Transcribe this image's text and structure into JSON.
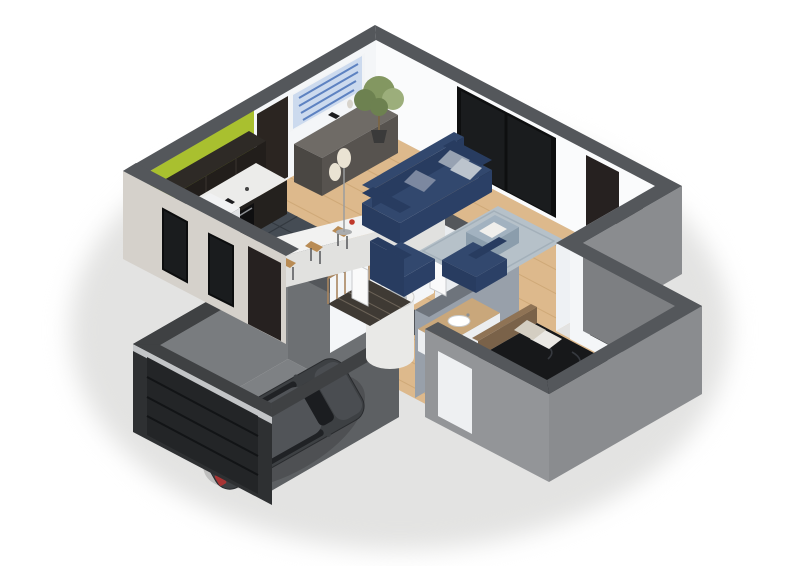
{
  "meta": {
    "type": "3d-isometric-floor-plan",
    "description": "Cutaway 3D floor plan of a one-storey house viewed from above on a white background: open kitchen, living room, bedroom, bathroom, hallway with staircase, and attached garage with a parked dark grey hatchback car",
    "background": "#ffffff"
  },
  "rooms": [
    {
      "name": "kitchen",
      "floor": "dark slate tiles",
      "features": [
        "lime green accent wall",
        "black gloss upper cabinets",
        "black base units with oven",
        "white island bar with wooden stools",
        "white fridge"
      ]
    },
    {
      "name": "living-room",
      "floor": "light oak planks",
      "features": [
        "navy three-seat sofa with grey cushions",
        "two navy cube armchairs",
        "blue-grey rug with ottoman",
        "dark sideboard",
        "blue abstract wall art",
        "potted ficus tree",
        "double floor lamp",
        "sliding glass window",
        "dark entry door"
      ]
    },
    {
      "name": "bedroom",
      "floor": "light oak planks",
      "features": [
        "double bed with dark patterned duvet",
        "wooden frame and headboard",
        "striped runner rug",
        "dark door",
        "window"
      ]
    },
    {
      "name": "bathroom",
      "features": [
        "round white shower tub",
        "wood-top vanity with basin",
        "grey feature wall"
      ]
    },
    {
      "name": "hallway",
      "features": [
        "staircase with wooden balusters and handrail",
        "white interior doors ajar"
      ]
    },
    {
      "name": "garage",
      "floor": "grey concrete",
      "features": [
        "dark grey hatchback car",
        "sectional garage door",
        "dark concrete walls"
      ]
    }
  ],
  "colors": {
    "bg": "#ffffff",
    "shadow": "#e3e3e2",
    "band": "#54575b",
    "bandGarage": "#3f4143",
    "wallWhite": "#f4f6f8",
    "wallWhite2": "#fafbfc",
    "wallWhiteShade": "#e9ecef",
    "wallInnerLight": "#eef1f4",
    "wallInnerShade": "#e3e6ea",
    "wallWarm": "#d5d1cb",
    "wallGreyRight": "#8a8c8f",
    "wallGreyWingBack": "#7d7f82",
    "wallGreyWingRight": "#939598",
    "greyFeatureWall": "#98a0aa",
    "greyFeatureBand": "#6e747c",
    "woodFloor": "#ddb98c",
    "plankLine": "#c69e6b",
    "tileFloor": "#454c54",
    "tileLine": "#333940",
    "garageFloor": "#7e8184",
    "garageSpeckle": "#6b6e71",
    "garageWallLight": "#797c7f",
    "garageWallBack": "#6d7073",
    "garageWallRight": "#5d6063",
    "garageOuterDark": "#3a3c3e",
    "garageDoorWall": "#2e3032",
    "garageDoor": "#232527",
    "garageDoorLine": "#121416",
    "garageLintel": "#c3c5c7",
    "glass": "#1a1c1e",
    "glassFrame": "#0e0f10",
    "doorDark": "#262120",
    "doorKitchen": "#2b2521",
    "greenWall": "#a9c02f",
    "cabinetDark": "#221e1b",
    "cabinetTop": "#2e2a26",
    "counterWhite": "#ececea",
    "counterFace": "#24211e",
    "ovenBlack": "#0f0f10",
    "ovenHandle": "#8d9094",
    "applianceWhite": "#f1f2f3",
    "applianceSide": "#e0e2e4",
    "islandTop": "#f2f2f1",
    "islandFace": "#e1e1df",
    "islandSide": "#d7d7d5",
    "stoolWood": "#b98c55",
    "stoolLeg": "#4a4c4e",
    "flowerRed": "#c0392b",
    "sofaNavy": "#32486e",
    "sofaNavyDark": "#283c60",
    "sofaNavyFace": "#2b4066",
    "pillowLight": "#bcc4cd",
    "pillowMid": "#97a2b2",
    "pillowDark": "#7c88a0",
    "rugBlue": "#b6c1c9",
    "rugBorder": "#a3b0ba",
    "ottoman": "#a2b2c0",
    "ottomanFace": "#8b9dac",
    "tray": "#f0efec",
    "sideboardTop": "#6f6b66",
    "sideboardFront": "#57534f",
    "sideboardSide": "#4a4743",
    "artBg": "#ccdaee",
    "artStroke": "#5d82c1",
    "artFrame": "#f2f4f6",
    "plantDark": "#6d8150",
    "plantMid": "#839761",
    "plantLight": "#9cae7b",
    "pot": "#3a3a3a",
    "trunk": "#7a6648",
    "lampShade": "#eae3d3",
    "lampPole": "#9a9c9e",
    "stairs": "#3f3a34",
    "stairLine": "#6b6257",
    "baluster": "#a8855f",
    "bedDuvet": "#17181a",
    "bedPattern": "#36393f",
    "bedWood": "#8f7355",
    "bedWoodDark": "#7a6249",
    "pillowWhite": "#eae8e4",
    "pillowBeige": "#d4cec2",
    "throwWhite": "#edece8",
    "rugStripeBase": "#e8e1d5",
    "rugStripeA": "#8a6a4e",
    "rugStripeC": "#4a4238",
    "shower": "#e9e9e7",
    "showerTop": "#f4f4f2",
    "showerInner": "#b9bdc0",
    "vanityWood": "#c9a77b",
    "basinWhite": "#ffffff",
    "vanityFace": "#eceef0",
    "carBody": "#3d4043",
    "carRoof": "#515458",
    "carNose": "#4a4d51",
    "carGlass": "#1b1d20",
    "carTail": "#a83434",
    "whiteDoor": "#fafafa",
    "whiteDoorEdge": "#c9cbcd",
    "windowPane": "#eef0f2",
    "itemDark": "#1d1d1f",
    "itemCream": "#d8d4cc",
    "itemBust": "#e5ded0",
    "sinkGrey": "#c6c9cb"
  }
}
